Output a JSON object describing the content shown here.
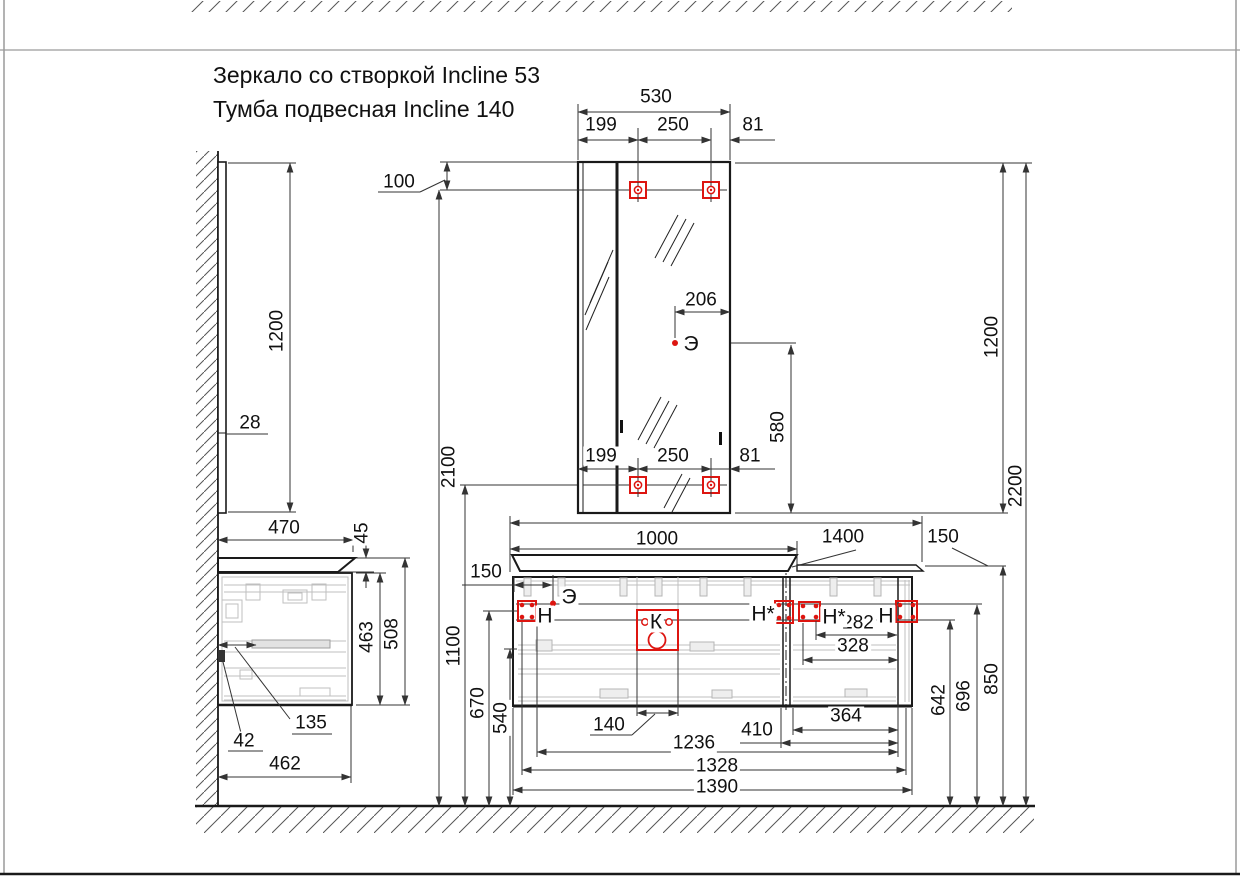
{
  "title": {
    "line1": "Зеркало со створкой Incline 53",
    "line2": "Тумба подвесная Incline 140"
  },
  "colors": {
    "line": "#1a1a1a",
    "dimension": "#333333",
    "detail_gray": "#bfbfbf",
    "accent_red": "#dd1510"
  },
  "labels": {
    "d530": "530",
    "d199_top": "199",
    "d250_top": "250",
    "d81_top": "81",
    "d100": "100",
    "d206": "206",
    "d199_bottom": "199",
    "d250_bottom": "250",
    "d81_bottom": "81",
    "d1200_mirror_side": "1200",
    "d28": "28",
    "d470": "470",
    "d45": "45",
    "d2100": "2100",
    "d1100": "1100",
    "d670": "670",
    "d540": "540",
    "d580": "580",
    "d1200_mirror_front": "1200",
    "d2200": "2200",
    "d463": "463",
    "d508": "508",
    "d135": "135",
    "d42": "42",
    "d462": "462",
    "d1000": "1000",
    "d1400": "1400",
    "d150_right": "150",
    "d150_outlet": "150",
    "d282": "282",
    "d328": "328",
    "d364": "364",
    "d410": "410",
    "d140": "140",
    "d1236": "1236",
    "d1328": "1328",
    "d1390": "1390",
    "d642": "642",
    "d696": "696",
    "d850": "850",
    "m_outlet_upper": "Э",
    "m_outlet_lower": "Э",
    "m_drain": "К",
    "m_mount_left": "Н",
    "m_mount_star_1": "Н*",
    "m_mount_star_2": "Н*",
    "m_mount_right": "Н"
  }
}
